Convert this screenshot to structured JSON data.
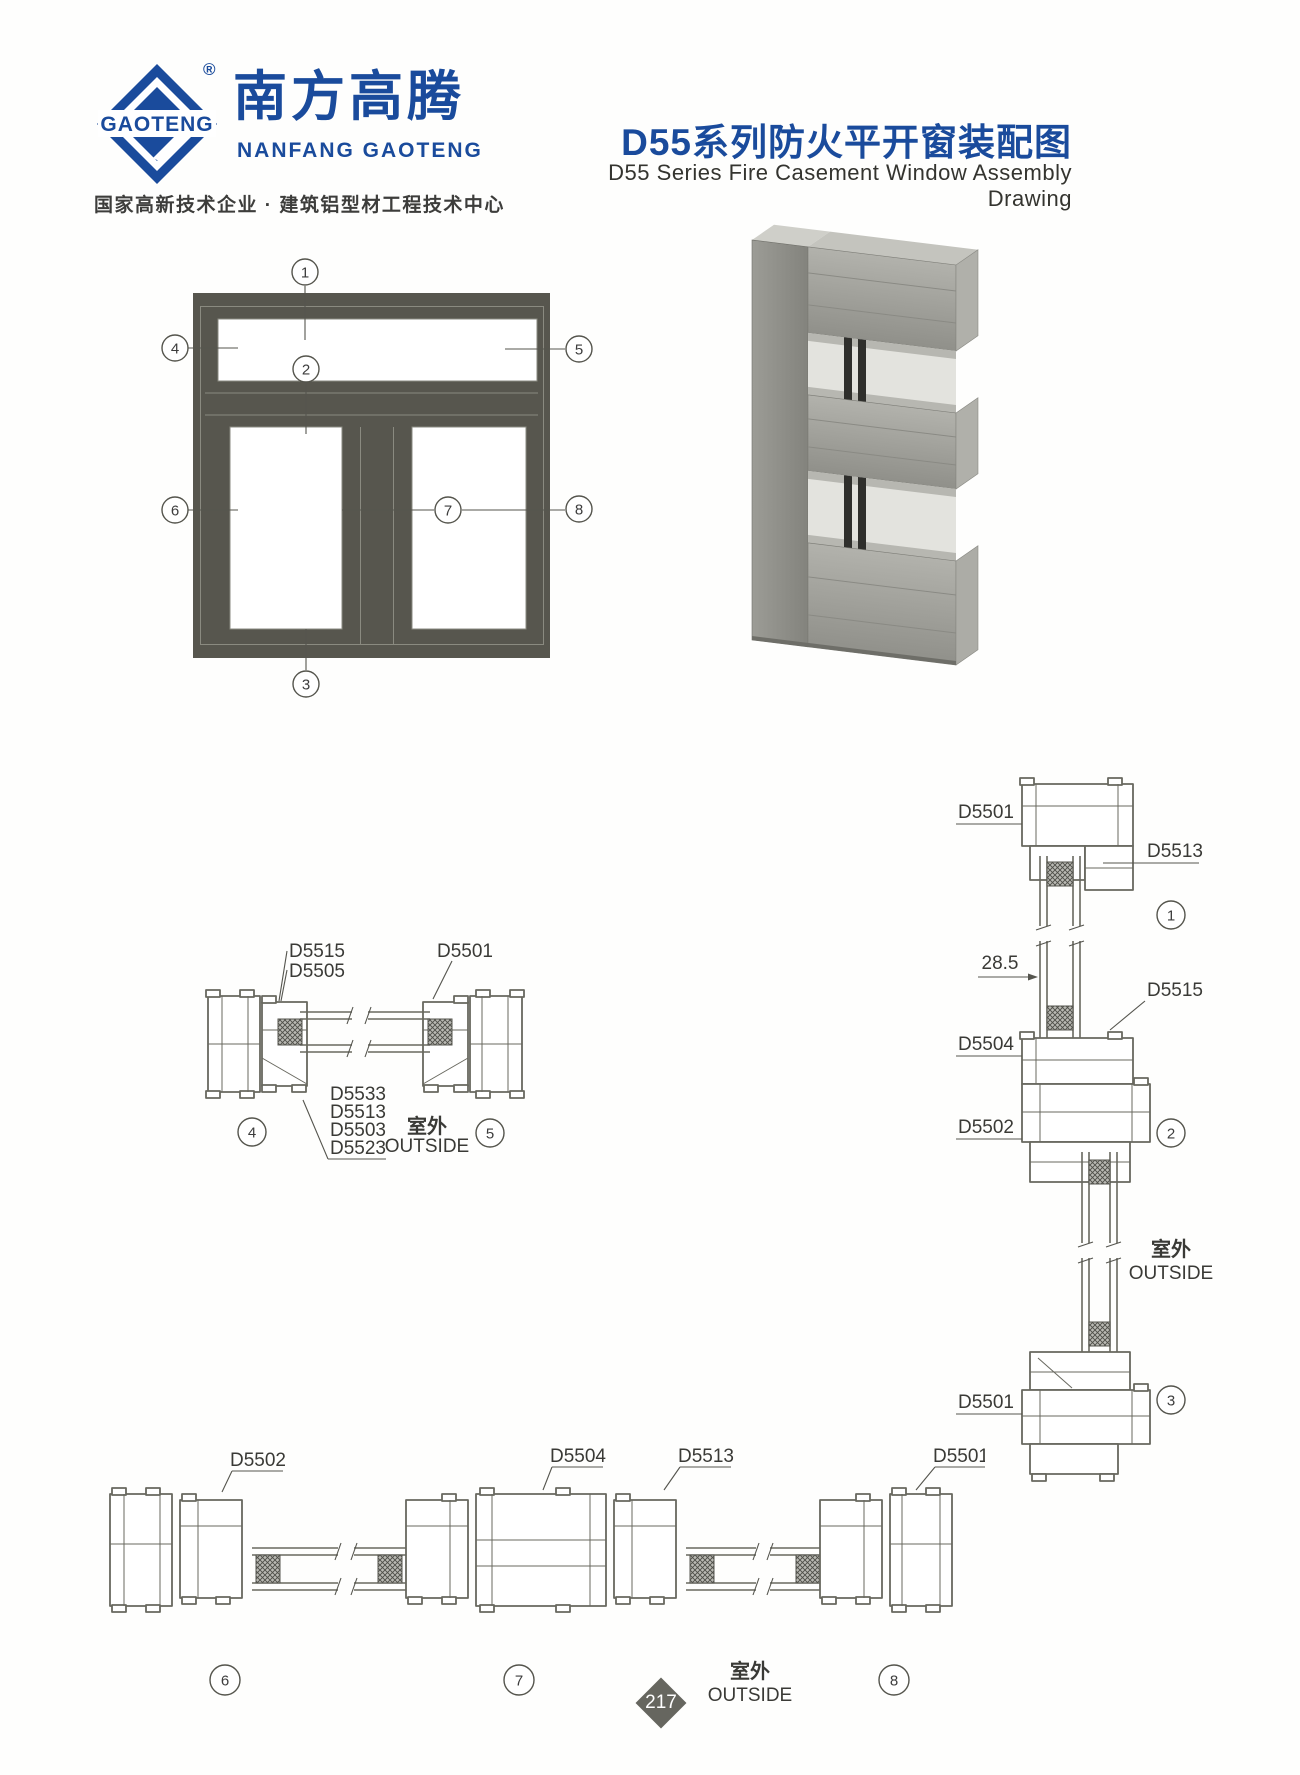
{
  "header": {
    "logo": {
      "brand_mark": "GAOTENG",
      "registered": "®",
      "cn_name": "南方高腾",
      "en_name": "NANFANG GAOTENG",
      "tagline": "国家高新技术企业 · 建筑铝型材工程技术中心"
    },
    "title_cn": "D55系列防火平开窗装配图",
    "title_en": "D55 Series Fire Casement Window Assembly Drawing"
  },
  "elevation": {
    "callouts": [
      "1",
      "2",
      "3",
      "4",
      "5",
      "6",
      "7",
      "8"
    ]
  },
  "section_45": {
    "label_d5515": "D5515",
    "label_d5505": "D5505",
    "label_d5501": "D5501",
    "stack_labels": [
      "D5533",
      "D5513",
      "D5503",
      "D5523"
    ],
    "outside_cn": "室外",
    "outside_en": "OUTSIDE",
    "callout_4": "4",
    "callout_5": "5"
  },
  "section_vertical": {
    "label_head_frame": "D5501",
    "label_sash": "D5513",
    "callout_1": "1",
    "dim_285": "28.5",
    "label_d5515": "D5515",
    "label_d5504": "D5504",
    "label_d5502": "D5502",
    "callout_2": "2",
    "outside_cn": "室外",
    "outside_en": "OUTSIDE",
    "label_sill_frame": "D5501",
    "callout_3": "3"
  },
  "section_horizontal": {
    "label_d5502": "D5502",
    "label_d5504": "D5504",
    "label_d5513": "D5513",
    "label_d5501": "D5501",
    "callout_6": "6",
    "callout_7": "7",
    "callout_8": "8",
    "outside_cn": "室外",
    "outside_en": "OUTSIDE"
  },
  "footer": {
    "page_number": "217"
  }
}
